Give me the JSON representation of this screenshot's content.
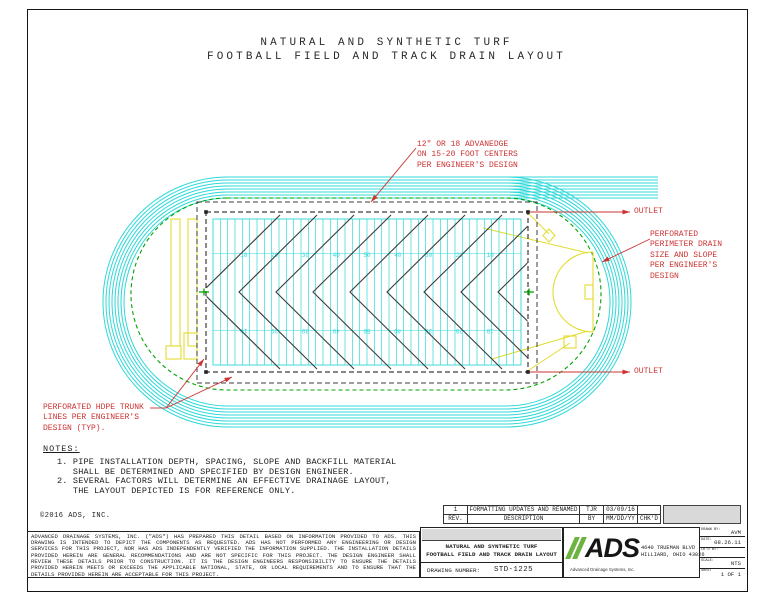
{
  "sheet_title": {
    "line1": "NATURAL AND SYNTHETIC TURF",
    "line2": "FOOTBALL FIELD AND TRACK DRAIN LAYOUT"
  },
  "annotations": {
    "advanedge": "12\" OR 18 ADVANEDGE\nON 15-20 FOOT CENTERS\nPER ENGINEER'S DESIGN",
    "outlet_top": "OUTLET",
    "outlet_bottom": "OUTLET",
    "perimeter_drain": "PERFORATED\nPERIMETER DRAIN\nSIZE AND SLOPE\nPER ENGINEER'S\nDESIGN",
    "trunk_lines": "PERFORATED HDPE TRUNK\nLINES PER ENGINEER'S\nDESIGN (TYP)."
  },
  "field": {
    "yard_numbers": [
      "10",
      "20",
      "30",
      "40",
      "50",
      "40",
      "30",
      "20",
      "10"
    ]
  },
  "notes": {
    "heading": "NOTES:",
    "items": "1. PIPE INSTALLATION DEPTH, SPACING, SLOPE AND BACKFILL MATERIAL\n   SHALL BE DETERMINED AND SPECIFIED BY DESIGN ENGINEER.\n2. SEVERAL FACTORS WILL DETERMINE AN EFFECTIVE DRAINAGE LAYOUT,\n   THE LAYOUT DEPICTED IS FOR REFERENCE ONLY."
  },
  "copyright": "©2016 ADS, INC.",
  "disclaimer": "ADVANCED DRAINAGE SYSTEMS, INC. (\"ADS\") HAS PREPARED THIS DETAIL BASED ON INFORMATION PROVIDED TO ADS.  THIS DRAWING IS INTENDED TO DEPICT THE COMPONENTS AS REQUESTED.  ADS HAS NOT PERFORMED ANY ENGINEERING OR DESIGN SERVICES FOR THIS PROJECT, NOR HAS ADS INDEPENDENTLY VERIFIED THE INFORMATION SUPPLIED.  THE INSTALLATION DETAILS PROVIDED HEREIN ARE GENERAL RECOMMENDATIONS AND ARE NOT SPECIFIC FOR THIS PROJECT.  THE DESIGN ENGINEER SHALL REVIEW THESE DETAILS PRIOR TO CONSTRUCTION.  IT IS THE DESIGN ENGINEERS RESPONSIBILITY TO ENSURE THE DETAILS PROVIDED HEREIN MEETS OR EXCEEDS THE APPLICABLE NATIONAL, STATE, OR LOCAL REQUIREMENTS AND TO ENSURE THAT THE DETAILS PROVIDED HEREIN ARE ACCEPTABLE FOR THIS PROJECT.",
  "revision_table": {
    "headers": {
      "rev": "REV.",
      "description": "DESCRIPTION",
      "by": "BY",
      "date": "MM/DD/YY",
      "chkd": "CHK'D"
    },
    "rows": [
      {
        "rev": "1",
        "description": "FORMATTING UPDATES AND RENAMED",
        "by": "TJR",
        "date": "03/09/16",
        "chkd": ""
      }
    ]
  },
  "title_block": {
    "project_title": "NATURAL AND SYNTHETIC TURF\nFOOTBALL FIELD AND TRACK DRAIN LAYOUT",
    "drawing_number_label": "DRAWING NUMBER:",
    "drawing_number": "STD-1225",
    "company": {
      "logo_text": "ADS",
      "tagline": "Advanced Drainage Systems, Inc.",
      "address": "4640 TRUEMAN BLVD\nHILLIARD, OHIO 43026"
    },
    "fields": [
      {
        "label": "DRAWN BY:",
        "value": "AVM"
      },
      {
        "label": "DATE:",
        "value": "08.26.11"
      },
      {
        "label": "CK'D BY:",
        "value": ""
      },
      {
        "label": "SCALE:",
        "value": "NTS"
      },
      {
        "label": "SHEET",
        "value": "1 OF 1"
      }
    ]
  },
  "colors": {
    "track_cyan": "#2fd8d8",
    "drain_green": "#00a400",
    "equipment_yellow": "#e3dc30",
    "annotation_red": "#cc3333",
    "line_dark": "#3c3c3c",
    "logo_green": "#6cb33f"
  }
}
